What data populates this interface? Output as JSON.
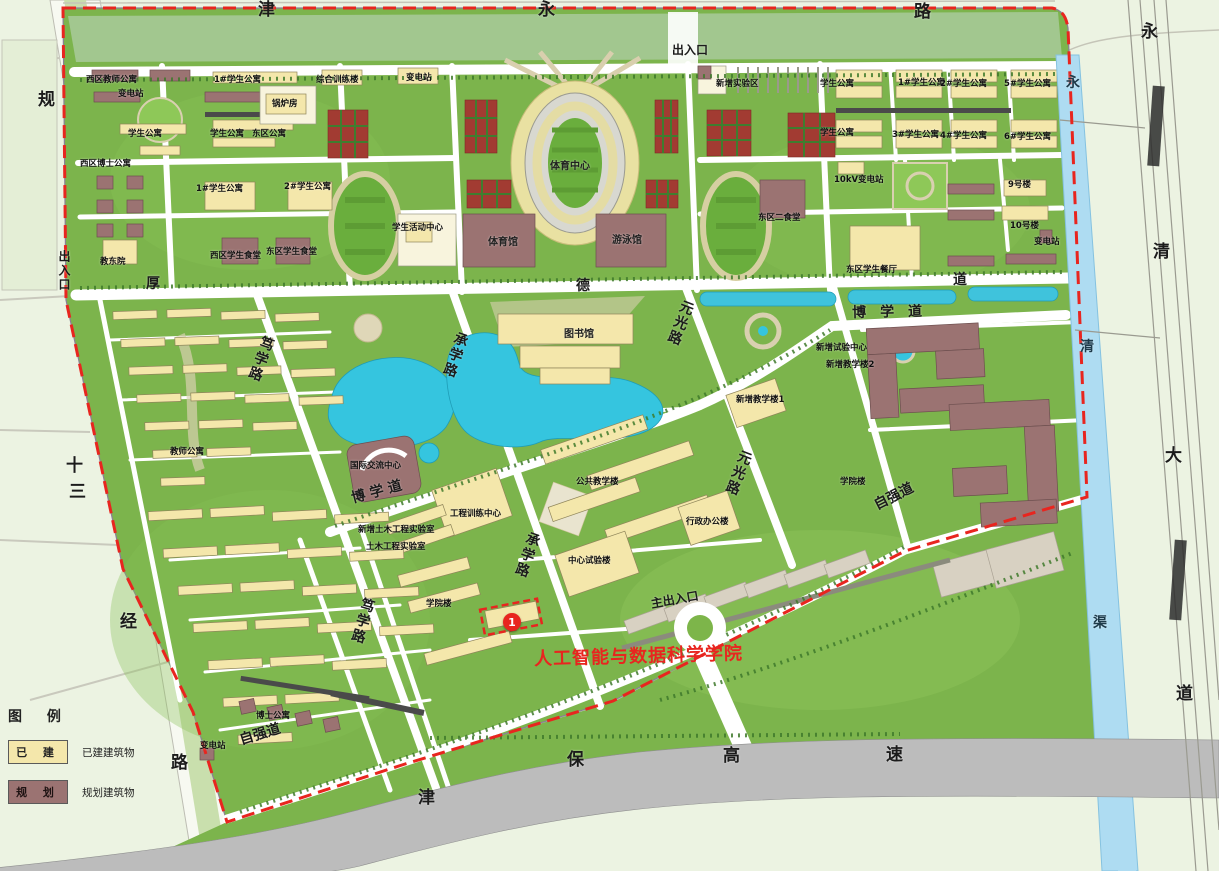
{
  "legend": {
    "title": "图 例",
    "items": [
      {
        "label": "已 建",
        "desc": "已建建筑物",
        "swatch": "built"
      },
      {
        "label": "规 划",
        "desc": "规划建筑物",
        "swatch": "planned"
      }
    ]
  },
  "highlight": {
    "marker": "1",
    "label": "人工智能与数据科学学院"
  },
  "colors": {
    "built": "#f4e7ab",
    "planned": "#9b7372",
    "boundary": "#e8251f",
    "grass": "#7cb44c",
    "water": "#35c5df",
    "canal": "#aedcf2",
    "highway": "#bcbcbc",
    "court": "#a23b32"
  },
  "map": {
    "roads": [
      "津永路",
      "规十三经路",
      "永清大道",
      "永清渠",
      "津保高速",
      "厚德道",
      "博学道",
      "笃学路",
      "承学路",
      "元光路",
      "自强道"
    ],
    "entrances": [
      "出入口",
      "出入口",
      "主出入口"
    ],
    "labels": [
      {
        "t": "津",
        "x": 258,
        "y": 2,
        "k": "r1"
      },
      {
        "t": "永",
        "x": 538,
        "y": 2,
        "k": "r1"
      },
      {
        "t": "路",
        "x": 914,
        "y": 4,
        "k": "r1"
      },
      {
        "t": "出入口",
        "x": 672,
        "y": 44,
        "k": "r3"
      },
      {
        "t": "规",
        "x": 38,
        "y": 92,
        "k": "r1"
      },
      {
        "t": "出入口",
        "x": 58,
        "y": 250,
        "k": "r3",
        "v": 1
      },
      {
        "t": "十",
        "x": 66,
        "y": 458,
        "k": "r1"
      },
      {
        "t": "三",
        "x": 69,
        "y": 484,
        "k": "r1"
      },
      {
        "t": "经",
        "x": 120,
        "y": 614,
        "k": "r1"
      },
      {
        "t": "路",
        "x": 171,
        "y": 755,
        "k": "r1"
      },
      {
        "t": "永",
        "x": 1141,
        "y": 24,
        "k": "r1"
      },
      {
        "t": "清",
        "x": 1153,
        "y": 244,
        "k": "r1"
      },
      {
        "t": "大",
        "x": 1165,
        "y": 448,
        "k": "r1"
      },
      {
        "t": "道",
        "x": 1176,
        "y": 686,
        "k": "r1"
      },
      {
        "t": "永",
        "x": 1066,
        "y": 76,
        "k": "c"
      },
      {
        "t": "清",
        "x": 1080,
        "y": 340,
        "k": "c"
      },
      {
        "t": "渠",
        "x": 1093,
        "y": 616,
        "k": "c"
      },
      {
        "t": "津",
        "x": 418,
        "y": 790,
        "k": "r1"
      },
      {
        "t": "保",
        "x": 567,
        "y": 752,
        "k": "r1"
      },
      {
        "t": "高",
        "x": 723,
        "y": 748,
        "k": "r1"
      },
      {
        "t": "速",
        "x": 886,
        "y": 747,
        "k": "r1"
      },
      {
        "t": "厚",
        "x": 146,
        "y": 277,
        "k": "r2"
      },
      {
        "t": "德",
        "x": 576,
        "y": 279,
        "k": "r2"
      },
      {
        "t": "道",
        "x": 953,
        "y": 273,
        "k": "r2"
      },
      {
        "t": "博 学 道",
        "x": 350,
        "y": 492,
        "k": "r2",
        "r": -15
      },
      {
        "t": "博　学　道",
        "x": 852,
        "y": 306,
        "k": "r2",
        "r": -1
      },
      {
        "t": "笃学路",
        "x": 262,
        "y": 334,
        "k": "r2",
        "v": 1,
        "r": 20
      },
      {
        "t": "笃学路",
        "x": 362,
        "y": 596,
        "k": "r2",
        "v": 1,
        "r": 16
      },
      {
        "t": "承学路",
        "x": 456,
        "y": 330,
        "k": "r2",
        "v": 1,
        "r": 19
      },
      {
        "t": "承学路",
        "x": 528,
        "y": 530,
        "k": "r2",
        "v": 1,
        "r": 19
      },
      {
        "t": "元光路",
        "x": 682,
        "y": 298,
        "k": "r2",
        "v": 1,
        "r": 21
      },
      {
        "t": "元光路",
        "x": 740,
        "y": 448,
        "k": "r2",
        "v": 1,
        "r": 21
      },
      {
        "t": "自强道",
        "x": 238,
        "y": 734,
        "k": "r2",
        "r": -17
      },
      {
        "t": "自强道",
        "x": 872,
        "y": 500,
        "k": "r2",
        "r": -27
      },
      {
        "t": "主出入口",
        "x": 650,
        "y": 598,
        "k": "r3",
        "r": -10
      },
      {
        "t": "西区教师公寓",
        "x": 86,
        "y": 76,
        "k": "b"
      },
      {
        "t": "变电站",
        "x": 118,
        "y": 90,
        "k": "b"
      },
      {
        "t": "1#学生公寓",
        "x": 214,
        "y": 76,
        "k": "b"
      },
      {
        "t": "综合训练楼",
        "x": 316,
        "y": 76,
        "k": "b"
      },
      {
        "t": "锅炉房",
        "x": 272,
        "y": 100,
        "k": "b"
      },
      {
        "t": "学生公寓",
        "x": 128,
        "y": 130,
        "k": "b"
      },
      {
        "t": "学生公寓",
        "x": 210,
        "y": 130,
        "k": "b"
      },
      {
        "t": "东区公寓",
        "x": 252,
        "y": 130,
        "k": "b"
      },
      {
        "t": "西区博士公寓",
        "x": 80,
        "y": 160,
        "k": "b"
      },
      {
        "t": "1#学生公寓",
        "x": 196,
        "y": 185,
        "k": "b"
      },
      {
        "t": "2#学生公寓",
        "x": 284,
        "y": 183,
        "k": "b"
      },
      {
        "t": "教东院",
        "x": 100,
        "y": 258,
        "k": "b"
      },
      {
        "t": "西区学生食堂",
        "x": 210,
        "y": 252,
        "k": "b"
      },
      {
        "t": "东区学生食堂",
        "x": 266,
        "y": 248,
        "k": "b"
      },
      {
        "t": "变电站",
        "x": 406,
        "y": 74,
        "k": "b"
      },
      {
        "t": "学生活动中心",
        "x": 392,
        "y": 224,
        "k": "b"
      },
      {
        "t": "体育中心",
        "x": 550,
        "y": 162,
        "k": "b2"
      },
      {
        "t": "体育馆",
        "x": 488,
        "y": 238,
        "k": "b2"
      },
      {
        "t": "游泳馆",
        "x": 612,
        "y": 236,
        "k": "b2"
      },
      {
        "t": "新增实验区",
        "x": 716,
        "y": 80,
        "k": "b"
      },
      {
        "t": "东区二食堂",
        "x": 758,
        "y": 214,
        "k": "b"
      },
      {
        "t": "学生公寓",
        "x": 820,
        "y": 80,
        "k": "b"
      },
      {
        "t": "1#学生公寓",
        "x": 898,
        "y": 79,
        "k": "b"
      },
      {
        "t": "2#学生公寓",
        "x": 940,
        "y": 80,
        "k": "b"
      },
      {
        "t": "5#学生公寓",
        "x": 1004,
        "y": 80,
        "k": "b"
      },
      {
        "t": "学生公寓",
        "x": 820,
        "y": 129,
        "k": "b"
      },
      {
        "t": "3#学生公寓",
        "x": 892,
        "y": 131,
        "k": "b"
      },
      {
        "t": "4#学生公寓",
        "x": 940,
        "y": 132,
        "k": "b"
      },
      {
        "t": "6#学生公寓",
        "x": 1004,
        "y": 133,
        "k": "b"
      },
      {
        "t": "10kV变电站",
        "x": 834,
        "y": 176,
        "k": "b"
      },
      {
        "t": "9号楼",
        "x": 1008,
        "y": 181,
        "k": "b"
      },
      {
        "t": "10号楼",
        "x": 1010,
        "y": 222,
        "k": "b"
      },
      {
        "t": "变电站",
        "x": 1034,
        "y": 238,
        "k": "b"
      },
      {
        "t": "东区学生餐厅",
        "x": 846,
        "y": 266,
        "k": "b"
      },
      {
        "t": "图书馆",
        "x": 564,
        "y": 330,
        "k": "b2"
      },
      {
        "t": "教师公寓",
        "x": 170,
        "y": 448,
        "k": "b"
      },
      {
        "t": "国际交流中心",
        "x": 350,
        "y": 462,
        "k": "b"
      },
      {
        "t": "公共教学楼",
        "x": 576,
        "y": 478,
        "k": "b"
      },
      {
        "t": "工程训练中心",
        "x": 450,
        "y": 510,
        "k": "b"
      },
      {
        "t": "新增土木工程实验室",
        "x": 358,
        "y": 526,
        "k": "b"
      },
      {
        "t": "土木工程实验室",
        "x": 366,
        "y": 543,
        "k": "b"
      },
      {
        "t": "中心试验楼",
        "x": 568,
        "y": 557,
        "k": "b"
      },
      {
        "t": "学院楼",
        "x": 426,
        "y": 600,
        "k": "b"
      },
      {
        "t": "行政办公楼",
        "x": 686,
        "y": 518,
        "k": "b"
      },
      {
        "t": "新增试验中心",
        "x": 816,
        "y": 344,
        "k": "b"
      },
      {
        "t": "新增教学楼2",
        "x": 826,
        "y": 361,
        "k": "b"
      },
      {
        "t": "新增教学楼1",
        "x": 736,
        "y": 396,
        "k": "b"
      },
      {
        "t": "学院楼",
        "x": 840,
        "y": 478,
        "k": "b"
      },
      {
        "t": "博士公寓",
        "x": 256,
        "y": 712,
        "k": "b"
      },
      {
        "t": "变电站",
        "x": 200,
        "y": 742,
        "k": "b"
      }
    ]
  }
}
